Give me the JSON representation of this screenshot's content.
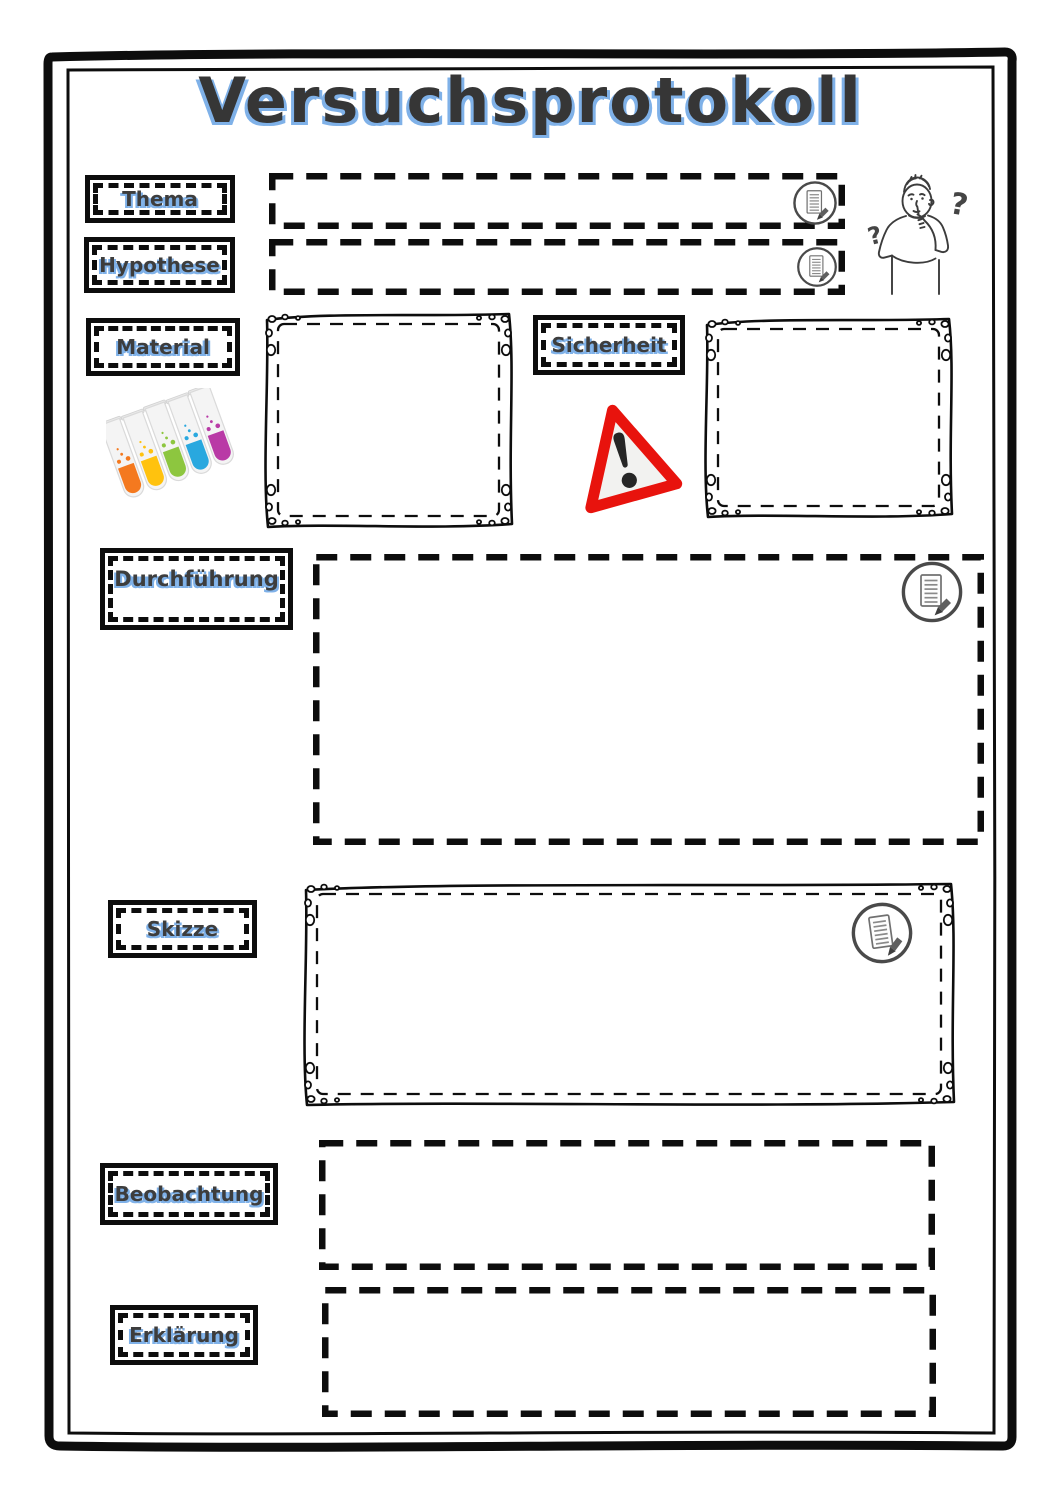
{
  "page": {
    "title": "Versuchsprotokoll"
  },
  "colors": {
    "accent_blue": "#7fb1e8",
    "ink": "#0d0d0d",
    "warning_red": "#e8130d",
    "icon_gray": "#4a4a4a",
    "tube_colors": [
      "#f4791f",
      "#ffc20e",
      "#8dc63f",
      "#29a8df",
      "#b93aa6"
    ]
  },
  "sections": {
    "thema": {
      "label": "Thema"
    },
    "hypothese": {
      "label": "Hypothese"
    },
    "material": {
      "label": "Material"
    },
    "sicherheit": {
      "label": "Sicherheit"
    },
    "durchfuehrung": {
      "label": "Durchführung"
    },
    "skizze": {
      "label": "Skizze"
    },
    "beobachtung": {
      "label": "Beobachtung"
    },
    "erklaerung": {
      "label": "Erklärung"
    }
  },
  "illustration": {
    "question_mark": "?"
  },
  "icons": {
    "edit_note": "document-with-pencil-in-circle",
    "warning": "red-warning-triangle-with-exclamation",
    "material": "five-colored-test-tubes",
    "header_right": "thinking-boy-with-question-marks"
  }
}
